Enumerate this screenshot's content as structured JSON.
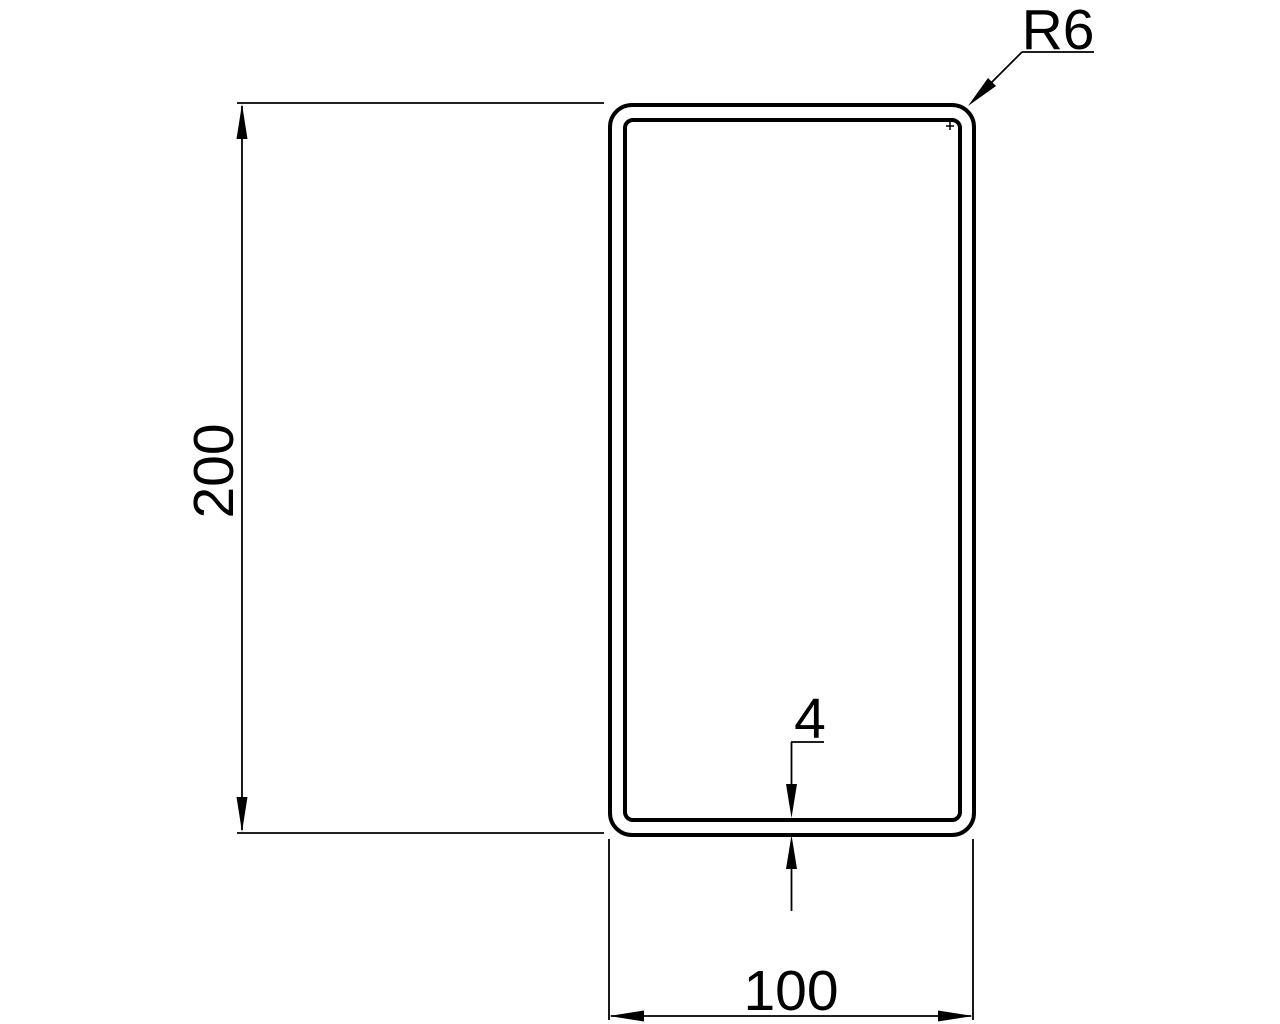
{
  "drawing": {
    "type": "technical-cross-section",
    "background_color": "#ffffff",
    "line_color": "#000000",
    "labels": {
      "height": "200",
      "width": "100",
      "wall_thickness": "4",
      "corner_radius": "R6"
    },
    "dimensions": {
      "height": 200,
      "width": 100,
      "wall_thickness": 4,
      "corner_radius": 6
    }
  }
}
